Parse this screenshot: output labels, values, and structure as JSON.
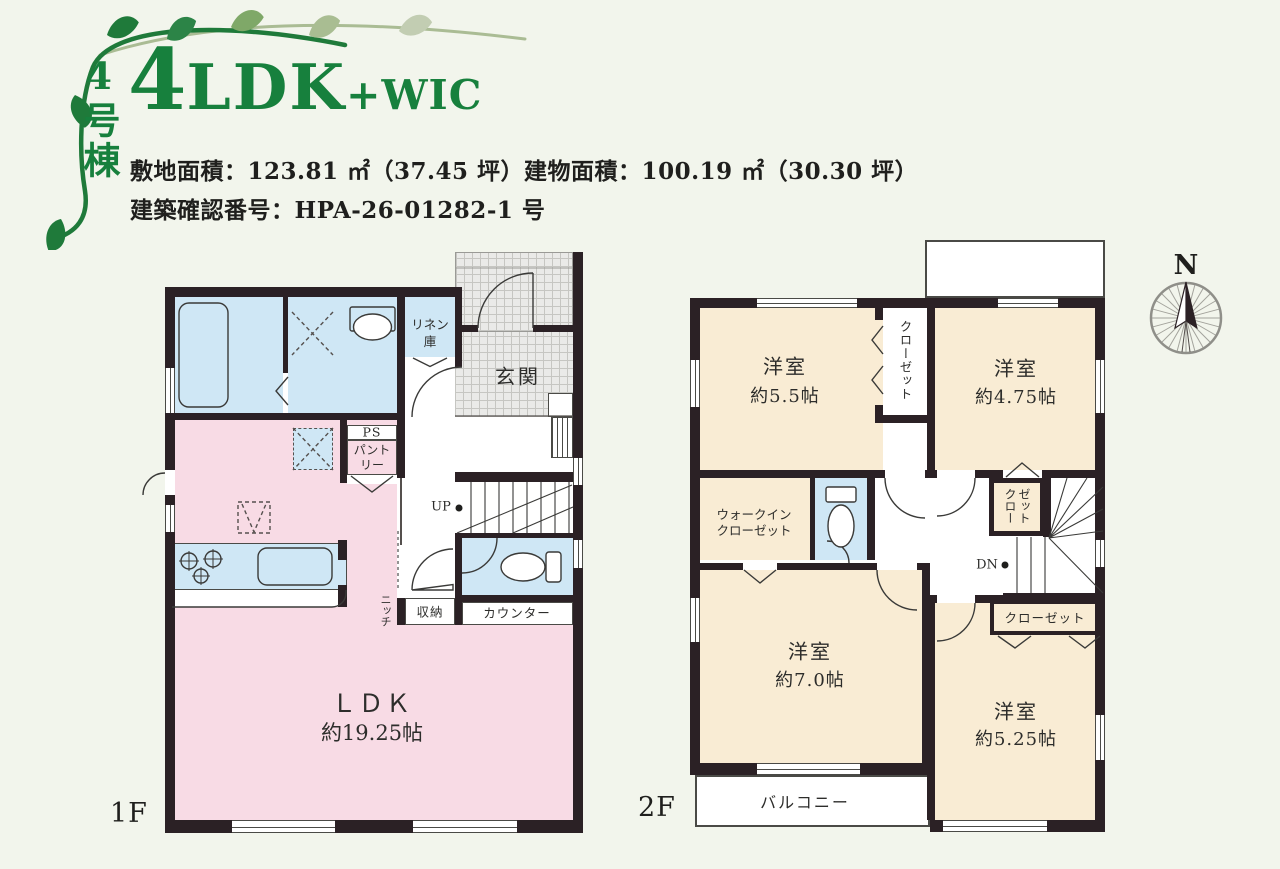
{
  "header": {
    "unit": "4号棟",
    "title_num": "4",
    "title_ldk": "LDK",
    "title_suffix": "+WIC",
    "spec_line1": "敷地面積：123.81 ㎡（37.45 坪）建物面積：100.19 ㎡（30.30 坪）",
    "spec_line2": "建築確認番号：HPA-26-01282-1 号"
  },
  "compass": {
    "north": "N"
  },
  "floor1": {
    "label": "1F",
    "genkan": "玄関",
    "linen1": "リネン",
    "linen2": "庫",
    "ps": "PS",
    "pantry1": "パント",
    "pantry2": "リー",
    "up": "UP",
    "storage": "収納",
    "counter": "カウンター",
    "niche": "ニッチ",
    "ldk": "ＬＤＫ",
    "ldk_size": "約19.25帖"
  },
  "floor2": {
    "label": "2F",
    "room_a": "洋室",
    "room_a_size": "約5.5帖",
    "closet_a": "クローゼット",
    "room_b": "洋室",
    "room_b_size": "約4.75帖",
    "wic1": "ウォークイン",
    "wic2": "クローゼット",
    "closet_b": "クローゼット",
    "dn": "DN",
    "room_c": "洋室",
    "room_c_size": "約7.0帖",
    "closet_c": "クローゼット",
    "room_d": "洋室",
    "room_d_size": "約5.25帖",
    "balcony": "バルコニー"
  },
  "colors": {
    "accent_green": "#17803d",
    "wall": "#2b2125",
    "room_pink": "#f8dbe5",
    "room_blue": "#cfe7f5",
    "room_cream": "#f9ecd4",
    "background": "#f2f5ec"
  }
}
